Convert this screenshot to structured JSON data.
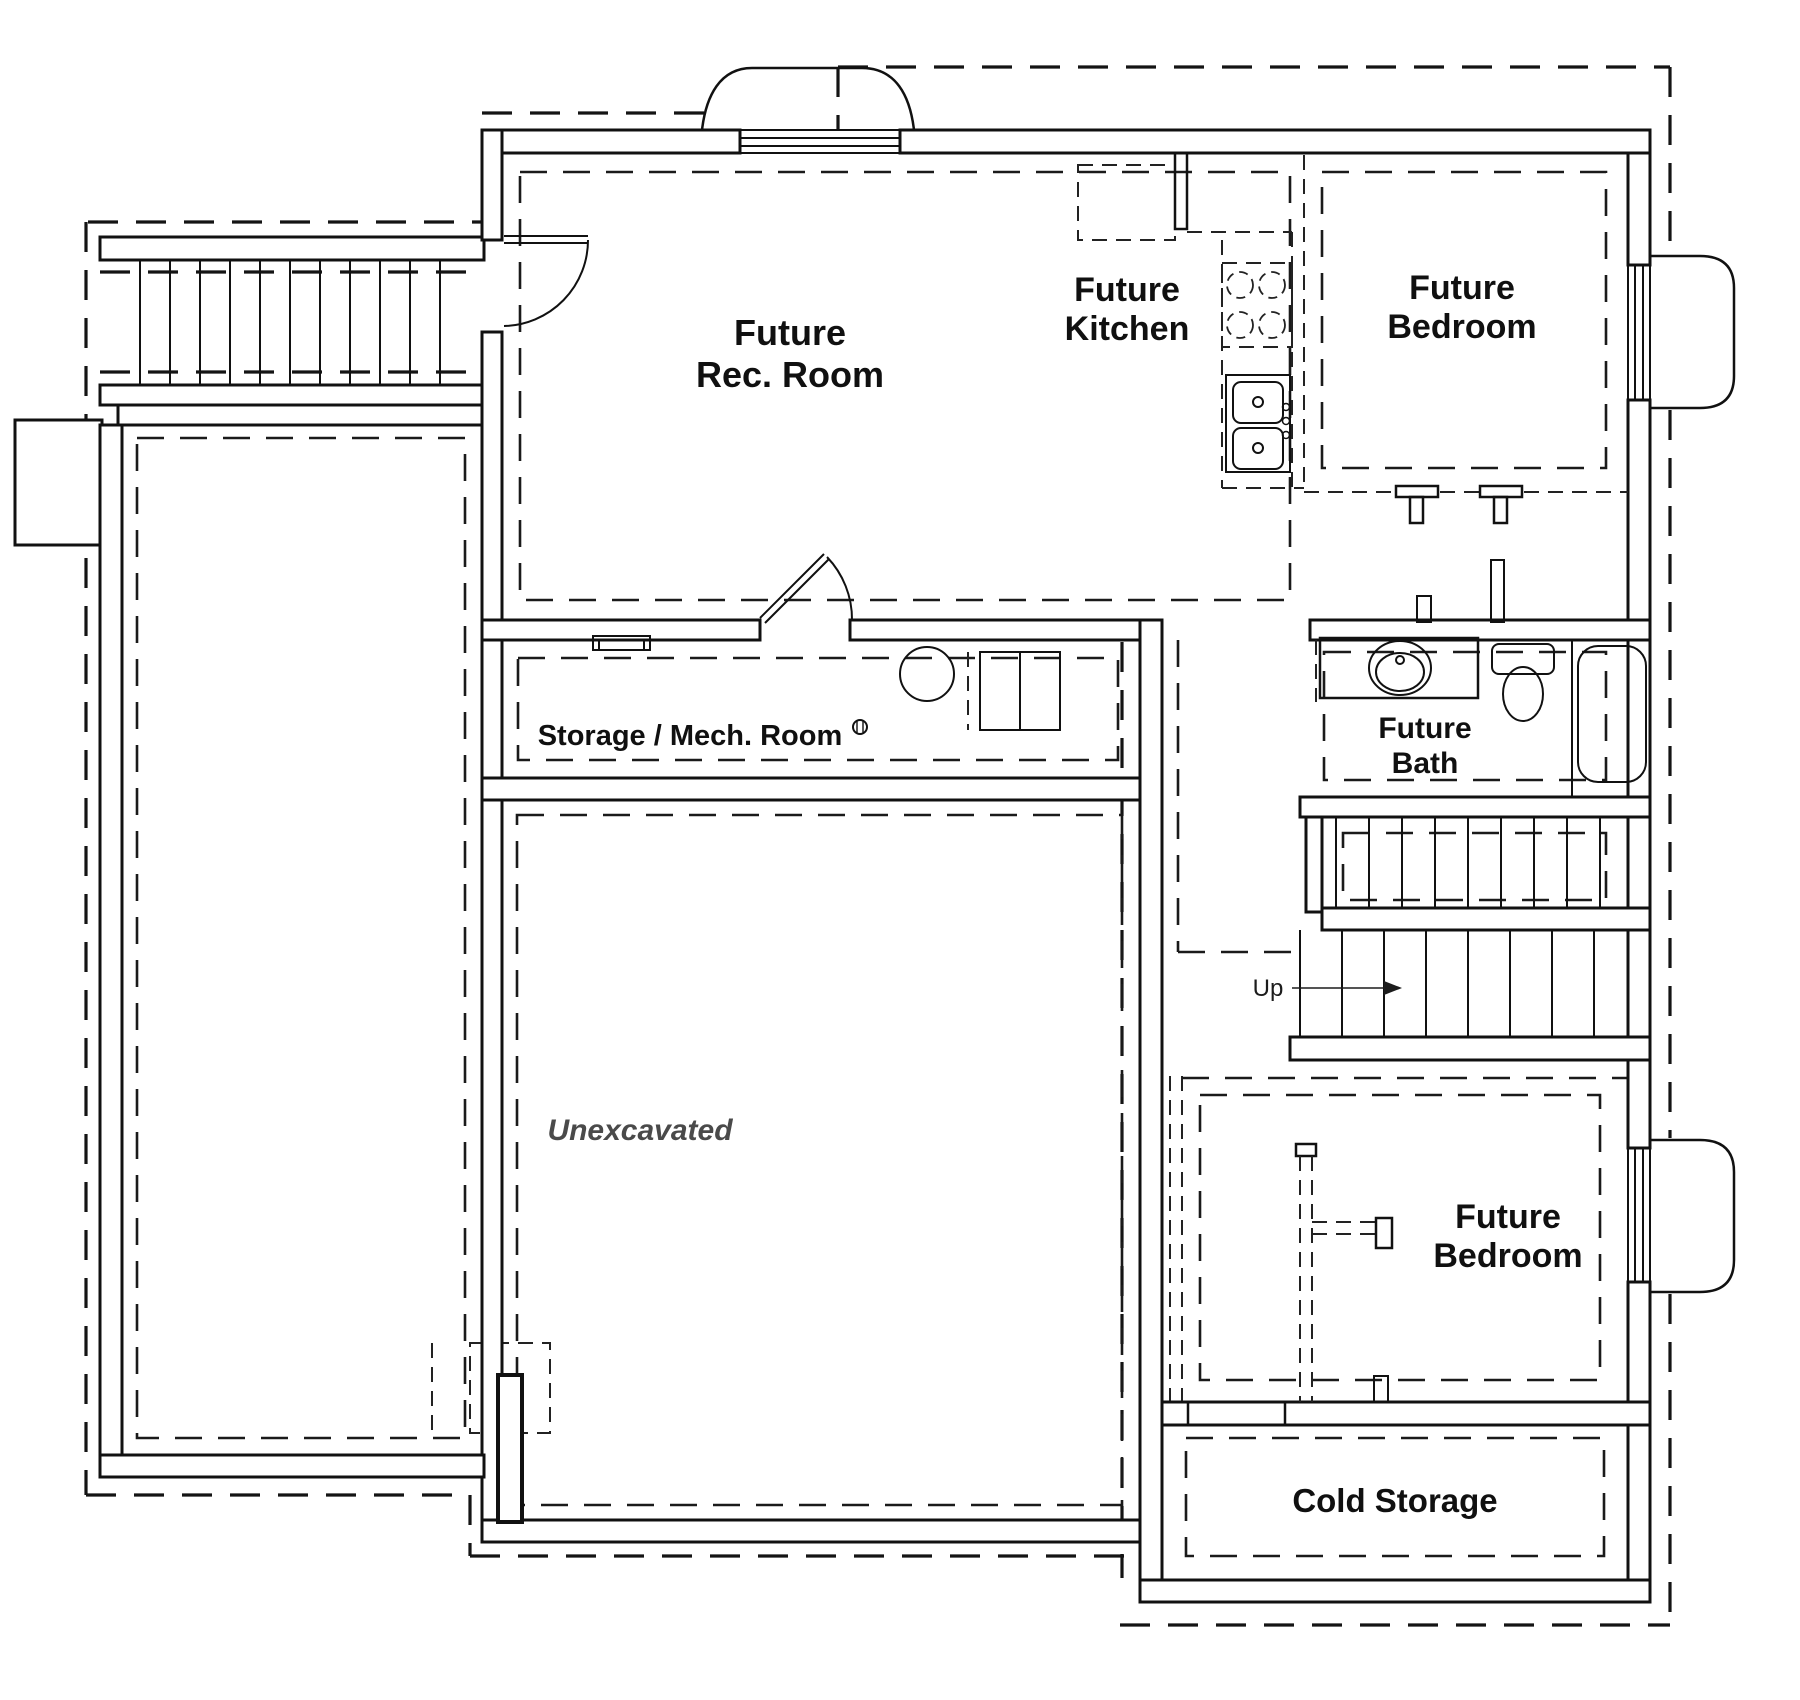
{
  "title": "Basement floor plan",
  "colors": {
    "line": "#111111",
    "unexcavated_text": "#4a4a4a",
    "background": "#ffffff"
  },
  "rooms": {
    "rec_room": {
      "lines": [
        "Future",
        "Rec. Room"
      ]
    },
    "kitchen": {
      "lines": [
        "Future",
        "Kitchen"
      ]
    },
    "bedroom_upper": {
      "lines": [
        "Future",
        "Bedroom"
      ]
    },
    "storage_mech": {
      "label": "Storage / Mech. Room"
    },
    "bath": {
      "lines": [
        "Future",
        "Bath"
      ]
    },
    "unexcavated": {
      "label": "Unexcavated"
    },
    "bedroom_lower": {
      "lines": [
        "Future",
        "Bedroom"
      ]
    },
    "cold_storage": {
      "label": "Cold Storage"
    }
  },
  "stairs": {
    "up_label": "Up"
  },
  "legend": {
    "solid_walls": "existing concrete walls",
    "dashed_lines": "future / footing lines"
  }
}
